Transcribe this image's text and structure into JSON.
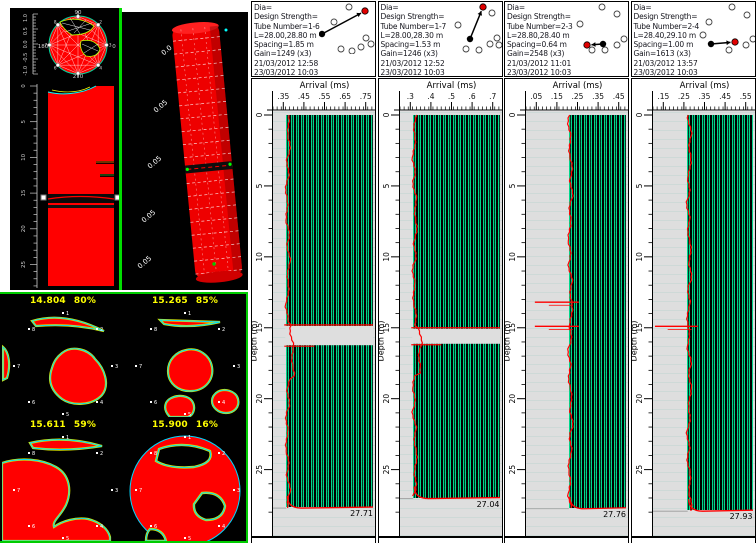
{
  "colors": {
    "pile_red": "#FF0000",
    "trace_green": "#00DC8C",
    "pick_red": "#FF0000",
    "background_black": "#000000",
    "label_yellow": "#FFFF00",
    "border_green": "#00CC00",
    "waterfall_gray": "#DEDEDE"
  },
  "left": {
    "front_view": {
      "angle_top": "90",
      "angle_right": "0",
      "angle_left": "180",
      "angle_bottom": "270",
      "radius_ticks": [
        "1.0",
        "0.5",
        "0.0",
        "-0.5",
        "-1.0"
      ],
      "depth_ticks": [
        "0",
        "5",
        "10",
        "15",
        "20",
        "25"
      ],
      "tube_numbers": [
        "1",
        "2",
        "3",
        "4",
        "5",
        "6",
        "7",
        "8"
      ]
    },
    "iso_view": {
      "axis_labels": [
        "0.0",
        "0.05",
        "0.05",
        "0.05",
        "0.05"
      ]
    },
    "sections": [
      {
        "depth": "14.804",
        "percent": "80%"
      },
      {
        "depth": "15.265",
        "percent": "85%"
      },
      {
        "depth": "15.611",
        "percent": "59%"
      },
      {
        "depth": "15.900",
        "percent": "16%"
      }
    ]
  },
  "panels": [
    {
      "dia": "Dia=",
      "design_strength": "Design Strength=",
      "tube_number": "Tube Number=1-6",
      "length": "L=28.00,28.80 m",
      "spacing": "Spacing=1.85 m",
      "gain": "Gain=1249 (x3)",
      "datetime1": "21/03/2012 12:58",
      "datetime2": "23/03/2012 10:03",
      "arrival_label": "Arrival (ms)",
      "arrival_ticks": [
        ".35",
        ".45",
        ".55",
        ".65",
        ".75"
      ],
      "depth_label": "Depth (m)",
      "depth_ticks": [
        "0",
        "5",
        "10",
        "15",
        "20",
        "25"
      ],
      "bottom_length": "27.71",
      "waveform": {
        "band_start_pct": 13,
        "defect": {
          "type": "gap",
          "top_m": 14.8,
          "bottom_m": 16.3
        }
      },
      "diagram": {
        "tubes": [
          [
            30,
            5
          ],
          [
            15,
            20
          ],
          [
            47,
            36
          ],
          [
            52,
            42
          ],
          [
            42,
            45
          ],
          [
            22,
            47
          ],
          [
            33,
            49
          ]
        ],
        "src": [
          3,
          32
        ],
        "rcv": [
          46,
          9
        ]
      }
    },
    {
      "dia": "Dia=",
      "design_strength": "Design Strength=",
      "tube_number": "Tube Number=1-7",
      "length": "L=28.00,28.30 m",
      "spacing": "Spacing=1.53 m",
      "gain": "Gain=1246 (x3)",
      "datetime1": "21/03/2012 12:52",
      "datetime2": "23/03/2012 10:03",
      "arrival_label": "Arrival (ms)",
      "arrival_ticks": [
        ".3",
        ".4",
        ".5",
        ".6",
        ".7"
      ],
      "depth_label": "Depth (m)",
      "depth_ticks": [
        "0",
        "5",
        "10",
        "15",
        "20",
        "25"
      ],
      "bottom_length": "27.04",
      "waveform": {
        "band_start_pct": 13,
        "defect": {
          "type": "gap",
          "top_m": 15.0,
          "bottom_m": 16.2
        }
      },
      "diagram": {
        "tubes": [
          [
            46,
            11
          ],
          [
            12,
            23
          ],
          [
            51,
            36
          ],
          [
            44,
            42
          ],
          [
            53,
            43
          ],
          [
            20,
            47
          ],
          [
            33,
            48
          ]
        ],
        "src": [
          24,
          37
        ],
        "rcv": [
          37,
          5
        ]
      }
    },
    {
      "dia": "Dia=",
      "design_strength": "Design Strength=",
      "tube_number": "Tube Number=2-3",
      "length": "L=28.80,28.40 m",
      "spacing": "Spacing=0.64 m",
      "gain": "Gain=2548 (x3)",
      "datetime1": "21/03/2012 11:01",
      "datetime2": "23/03/2012 10:03",
      "arrival_label": "Arrival (ms)",
      "arrival_ticks": [
        ".05",
        ".15",
        ".25",
        ".35",
        ".45"
      ],
      "depth_label": "Depth (m)",
      "depth_ticks": [
        "0",
        "5",
        "10",
        "15",
        "20",
        "25"
      ],
      "bottom_length": "27.76",
      "waveform": {
        "band_start_pct": 42,
        "defect": {
          "type": "streaks",
          "depths_m": [
            13.2,
            14.9
          ]
        }
      },
      "diagram": {
        "tubes": [
          [
            30,
            5
          ],
          [
            45,
            12
          ],
          [
            8,
            22
          ],
          [
            52,
            37
          ],
          [
            45,
            43
          ],
          [
            33,
            48
          ],
          [
            20,
            48
          ]
        ],
        "src": [
          31,
          42
        ],
        "rcv": [
          15,
          43
        ]
      }
    },
    {
      "dia": "Dia=",
      "design_strength": "Design Strength=",
      "tube_number": "Tube Number=2-4",
      "length": "L=28.40,29.10 m",
      "spacing": "Spacing=1.00 m",
      "gain": "Gain=1613 (x3)",
      "datetime1": "21/03/2012 13:57",
      "datetime2": "23/03/2012 10:03",
      "arrival_label": "Arrival (ms)",
      "arrival_ticks": [
        ".15",
        ".25",
        ".35",
        ".45",
        ".55"
      ],
      "depth_label": "Depth (m)",
      "depth_ticks": [
        "0",
        "5",
        "10",
        "15",
        "20",
        "25"
      ],
      "bottom_length": "27.93",
      "waveform": {
        "band_start_pct": 34,
        "defect": {
          "type": "streaks",
          "depths_m": [
            14.9
          ]
        }
      },
      "diagram": {
        "tubes": [
          [
            33,
            5
          ],
          [
            48,
            13
          ],
          [
            10,
            20
          ],
          [
            4,
            33
          ],
          [
            54,
            37
          ],
          [
            47,
            43
          ],
          [
            30,
            48
          ]
        ],
        "src": [
          12,
          42
        ],
        "rcv": [
          36,
          40
        ]
      }
    }
  ]
}
